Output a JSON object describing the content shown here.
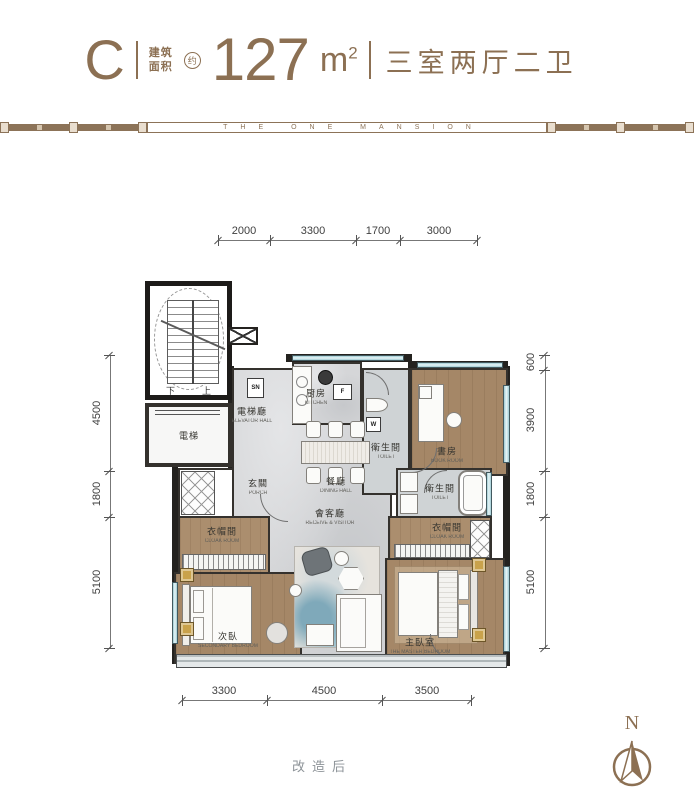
{
  "header": {
    "unit_type": "C",
    "area_label_1": "建筑",
    "area_label_2": "面积",
    "approx": "约",
    "area_number": "127",
    "area_unit": "m",
    "area_exp": "2",
    "layout": "三室两厅二卫"
  },
  "band": {
    "title": "THE ONE MANSION"
  },
  "dims": {
    "top": [
      "2000",
      "3300",
      "1700",
      "3000"
    ],
    "bottom": [
      "3300",
      "4500",
      "3500"
    ],
    "left": [
      "4500",
      "1800",
      "5100"
    ],
    "right": [
      "600",
      "3900",
      "1800",
      "5100"
    ]
  },
  "rooms": {
    "elevator_hall": {
      "zh": "電梯廳",
      "en": "ELEVATOR HALL"
    },
    "elevator": {
      "zh": "電梯"
    },
    "kitchen": {
      "zh": "厨房",
      "en": "KITCHEN"
    },
    "toilet_a": {
      "zh": "衛生間",
      "en": "TOILET"
    },
    "book_room": {
      "zh": "書房",
      "en": "BOOK ROOM"
    },
    "dining_hall": {
      "zh": "餐廳",
      "en": "DINING HALL"
    },
    "porch": {
      "zh": "玄關",
      "en": "PORCH"
    },
    "living": {
      "zh": "會客廳",
      "en": "RECEIVE & VISITOR"
    },
    "cloak_left": {
      "zh": "衣帽間",
      "en": "CLOAK ROOM"
    },
    "secondary_bedroom": {
      "zh": "次臥",
      "en": "SECONDARY BEDROOM"
    },
    "toilet_b": {
      "zh": "衛生間",
      "en": "TOILET"
    },
    "cloak_right": {
      "zh": "衣帽間",
      "en": "CLOAK ROOM"
    },
    "master_bedroom": {
      "zh": "主臥室",
      "en": "THE MASTER BEDROOM"
    }
  },
  "stair": {
    "down": "下",
    "up": "上"
  },
  "tags": {
    "sn": "SN",
    "f": "F",
    "w": "W"
  },
  "note": {
    "text": "改造后"
  },
  "compass": {
    "n": "N"
  },
  "colors": {
    "accent": "#8c7053",
    "wall": "#24221f",
    "wood": "#a58767",
    "marble": "#d5d6d8",
    "window": "#a8d3da",
    "gold": "#c9a24b"
  }
}
